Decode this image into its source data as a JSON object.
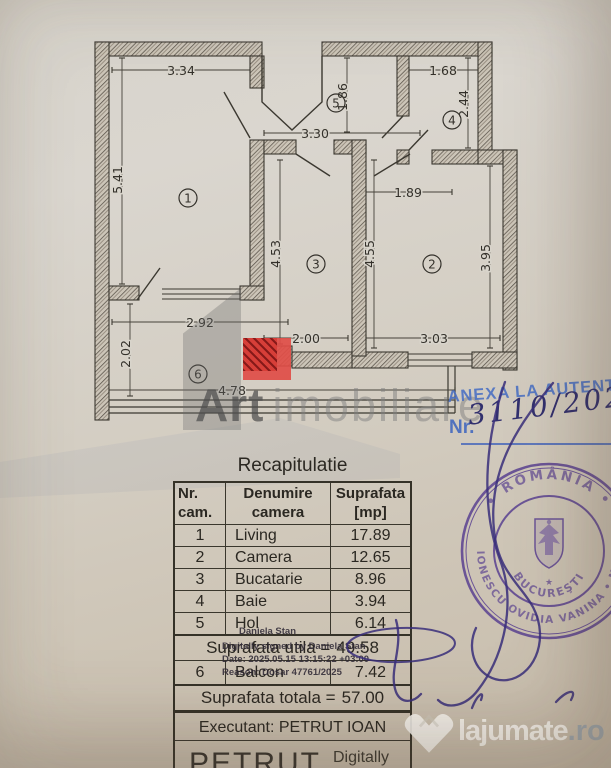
{
  "annex": {
    "title": "ANEXA LA AUTENTI",
    "nr_label": "Nr.",
    "nr_value": "3110/2025"
  },
  "watermark": {
    "bold": "Art",
    "light": "imobiliare"
  },
  "stamp": {
    "top": "• ROMÂNIA •",
    "ring": "IONESCU OVIDIA VANINA • NOT",
    "inner": "BUCUREŞTI",
    "star": "★"
  },
  "footer_logo": {
    "name": "lajumate",
    "tld": ".ro"
  },
  "floor_plan": {
    "room_numbers": {
      "r1": "1",
      "r2": "2",
      "r3": "3",
      "r4": "4",
      "r5": "5",
      "r6": "6"
    },
    "dims": {
      "d334": "3.34",
      "d541": "5.41",
      "d186": "1.86",
      "d330": "3.30",
      "d168": "1.68",
      "d244": "2.44",
      "d189": "1.89",
      "d453": "4.53",
      "d455": "4.55",
      "d395": "3.95",
      "d200": "2.00",
      "d303": "3.03",
      "d292": "2.92",
      "d202": "2.02",
      "d478": "4.78"
    }
  },
  "table": {
    "title": "Recapitulatie",
    "headers": {
      "nr": "Nr.\ncam.",
      "name": "Denumire\ncamera",
      "area": "Suprafata\n[mp]"
    },
    "rows": [
      {
        "nr": "1",
        "name": "Living",
        "mp": "17.89"
      },
      {
        "nr": "2",
        "name": "Camera",
        "mp": "12.65"
      },
      {
        "nr": "3",
        "name": "Bucatarie",
        "mp": "8.96"
      },
      {
        "nr": "4",
        "name": "Baie",
        "mp": "3.94"
      },
      {
        "nr": "5",
        "name": "Hol",
        "mp": "6.14"
      }
    ],
    "utila_label": "Suprafata utila =",
    "utila_value": "49.58",
    "balcon": {
      "nr": "6",
      "name": "Balcon",
      "mp": "7.42"
    },
    "totala_label": "Suprafata totala =",
    "totala_value": "57.00",
    "executant": "Executant: PETRUT IOAN",
    "signer": "PETRUT",
    "signer_note": "Digitally signed"
  },
  "digital_signature": {
    "name": "Daniela Stan",
    "line2": "Digitally signed by Daniela Stan",
    "line3": "Date: 2025.05.15 13:15:22 +03:00",
    "line4": "Reason: Dosar 47761/2025"
  },
  "colors": {
    "stamp_ink": "#53398f",
    "pen_ink": "#3a3079",
    "annex_blue": "#4a72c4",
    "logo_red": "#e04d46",
    "paper": "#d5d0c6"
  }
}
